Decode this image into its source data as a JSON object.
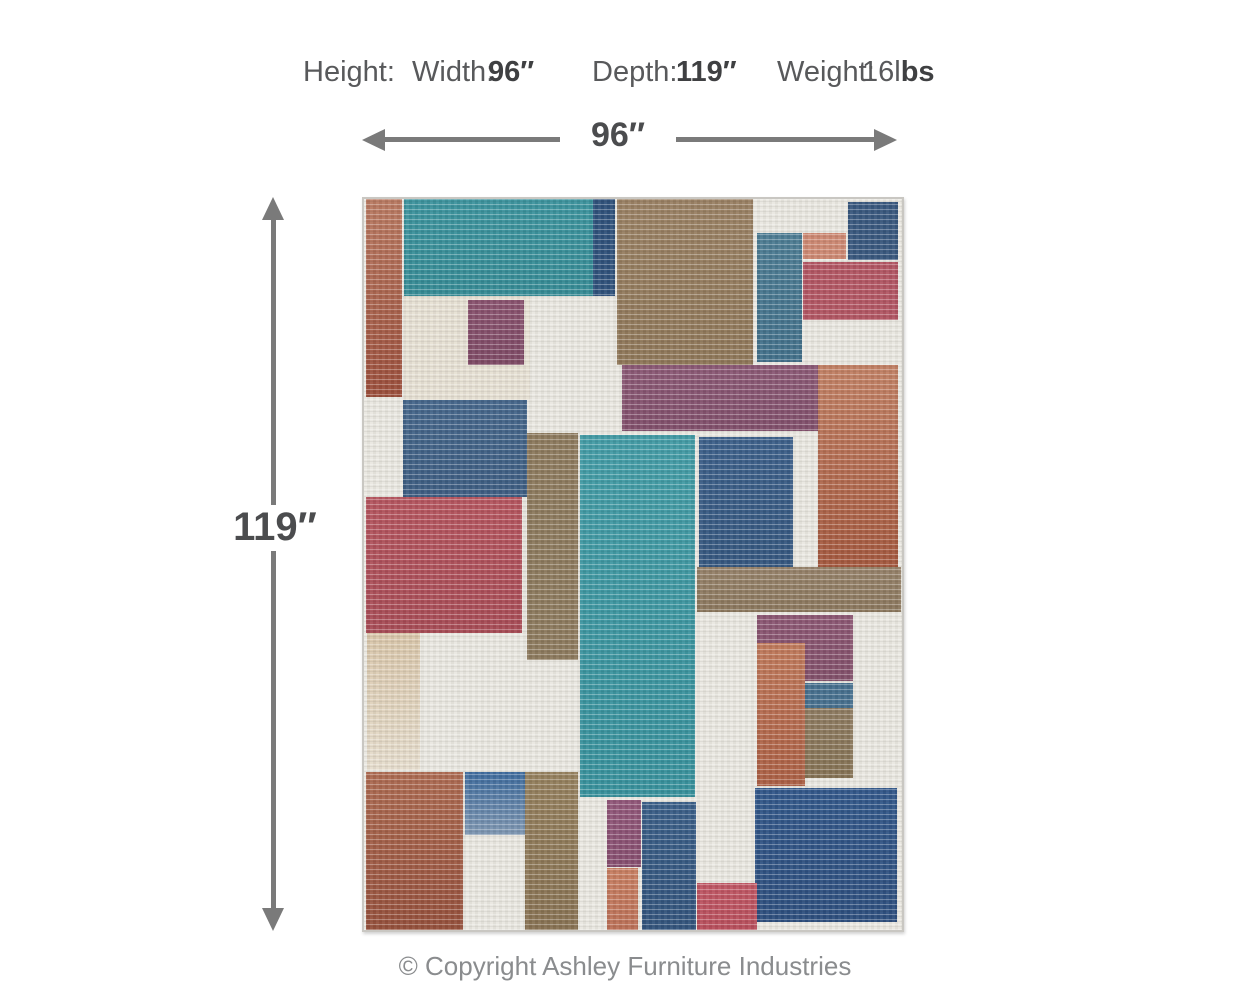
{
  "header": {
    "height_label": "Height:",
    "width_label": "Width:",
    "width_value": "96″",
    "depth_label": "Depth:",
    "depth_value": "119″",
    "weight_label": "Weight:",
    "weight_value_regular": "16l",
    "weight_value_bold": "bs"
  },
  "dimensions": {
    "width_arrow_label": "96″",
    "height_arrow_label": "119″",
    "arrow_color": "#7a7a7a",
    "label_color": "#4b4c4e"
  },
  "footer": {
    "copyright": "© Copyright Ashley Furniture Industries"
  },
  "rug": {
    "base_color": "#e9e7e0",
    "edge_color": "#c9c7c2",
    "blocks": [
      {
        "name": "patch-rust-strip-left",
        "x": 2,
        "y": 0,
        "w": 36,
        "h": 198,
        "c": "#b97a62",
        "c2": "#9b4e3b"
      },
      {
        "name": "patch-teal-top",
        "x": 40,
        "y": 0,
        "w": 189,
        "h": 97,
        "c": "#3d949e",
        "c2": "#368b95"
      },
      {
        "name": "patch-navy-strip-top",
        "x": 229,
        "y": 0,
        "w": 22,
        "h": 97,
        "c": "#30527b"
      },
      {
        "name": "patch-tan-big",
        "x": 253,
        "y": 0,
        "w": 136,
        "h": 166,
        "c": "#9a8164",
        "c2": "#8f7759"
      },
      {
        "name": "patch-navy-top-right",
        "x": 484,
        "y": 3,
        "w": 50,
        "h": 58,
        "c": "#39587e"
      },
      {
        "name": "patch-salmon-top-right",
        "x": 439,
        "y": 34,
        "w": 43,
        "h": 26,
        "c": "#cd8973"
      },
      {
        "name": "patch-crimson-top-right",
        "x": 439,
        "y": 63,
        "w": 95,
        "h": 58,
        "c": "#b25663"
      },
      {
        "name": "patch-bluegray-strip",
        "x": 393,
        "y": 34,
        "w": 45,
        "h": 129,
        "c": "#4e7d94",
        "c2": "#42708a"
      },
      {
        "name": "patch-cream-block",
        "x": 40,
        "y": 97,
        "w": 126,
        "h": 104,
        "c": "#e6e0d3"
      },
      {
        "name": "patch-plum-inset",
        "x": 104,
        "y": 101,
        "w": 56,
        "h": 65,
        "c": "#8a536f",
        "c2": "#7e4a65"
      },
      {
        "name": "patch-steelblue-left",
        "x": 39,
        "y": 201,
        "w": 124,
        "h": 97,
        "c": "#46678b",
        "c2": "#3d5d82"
      },
      {
        "name": "patch-crimson-left",
        "x": 2,
        "y": 298,
        "w": 156,
        "h": 136,
        "c": "#b5565f",
        "c2": "#a84c56"
      },
      {
        "name": "patch-taupe-strip-a",
        "x": 163,
        "y": 234,
        "w": 51,
        "h": 227,
        "c": "#8d7a5e"
      },
      {
        "name": "patch-teal-central",
        "x": 216,
        "y": 236,
        "w": 115,
        "h": 362,
        "c": "#449ca6",
        "c2": "#38919c"
      },
      {
        "name": "patch-plum-wide",
        "x": 258,
        "y": 166,
        "w": 196,
        "h": 66,
        "c": "#8c5a76",
        "c2": "#814f6b"
      },
      {
        "name": "patch-navy-center",
        "x": 335,
        "y": 238,
        "w": 94,
        "h": 130,
        "c": "#3d608a",
        "c2": "#35577f"
      },
      {
        "name": "patch-terracotta-tall",
        "x": 454,
        "y": 166,
        "w": 80,
        "h": 202,
        "c": "#c28165",
        "c2": "#a4583e"
      },
      {
        "name": "patch-tan-band",
        "x": 333,
        "y": 368,
        "w": 204,
        "h": 45,
        "c": "#96826a",
        "c2": "#8b775d"
      },
      {
        "name": "patch-beige-strip",
        "x": 3,
        "y": 434,
        "w": 53,
        "h": 137,
        "c": "#d9c6aa",
        "c2": "#e6ddcd"
      },
      {
        "name": "patch-rust-bottom-left",
        "x": 2,
        "y": 573,
        "w": 97,
        "h": 158,
        "c": "#ad6b52",
        "c2": "#95503c"
      },
      {
        "name": "patch-blue-bottom-left",
        "x": 101,
        "y": 573,
        "w": 60,
        "h": 63,
        "c": "#3e6b9d",
        "c2": "#37619397"
      },
      {
        "name": "patch-taupe-strip-b",
        "x": 161,
        "y": 573,
        "w": 53,
        "h": 158,
        "c": "#95805e",
        "c2": "#887253"
      },
      {
        "name": "patch-plum-small",
        "x": 243,
        "y": 601,
        "w": 34,
        "h": 67,
        "c": "#92587a",
        "c2": "#864e6f"
      },
      {
        "name": "patch-salmon-small",
        "x": 243,
        "y": 669,
        "w": 31,
        "h": 62,
        "c": "#c87f62",
        "c2": "#bb7057"
      },
      {
        "name": "patch-navy-tall",
        "x": 278,
        "y": 603,
        "w": 54,
        "h": 128,
        "c": "#3b5f88",
        "c2": "#33547c"
      },
      {
        "name": "patch-plum-l",
        "x": 393,
        "y": 416,
        "w": 96,
        "h": 66,
        "c": "#8d5874",
        "c2": "#82506a"
      },
      {
        "name": "patch-terracotta-col",
        "x": 393,
        "y": 444,
        "w": 48,
        "h": 143,
        "c": "#c07a5c",
        "c2": "#ab5f44"
      },
      {
        "name": "patch-blue-small-mid",
        "x": 441,
        "y": 484,
        "w": 48,
        "h": 25,
        "c": "#47708e"
      },
      {
        "name": "patch-taupe-small-mid",
        "x": 441,
        "y": 509,
        "w": 48,
        "h": 70,
        "c": "#8e7b61",
        "c2": "#857254"
      },
      {
        "name": "patch-navy-bottom-right",
        "x": 391,
        "y": 589,
        "w": 142,
        "h": 134,
        "c": "#33588a",
        "c2": "#2e4f7e"
      },
      {
        "name": "patch-crimson-bottom",
        "x": 333,
        "y": 684,
        "w": 60,
        "h": 47,
        "c": "#c05764",
        "c2": "#b84f5c"
      }
    ]
  }
}
